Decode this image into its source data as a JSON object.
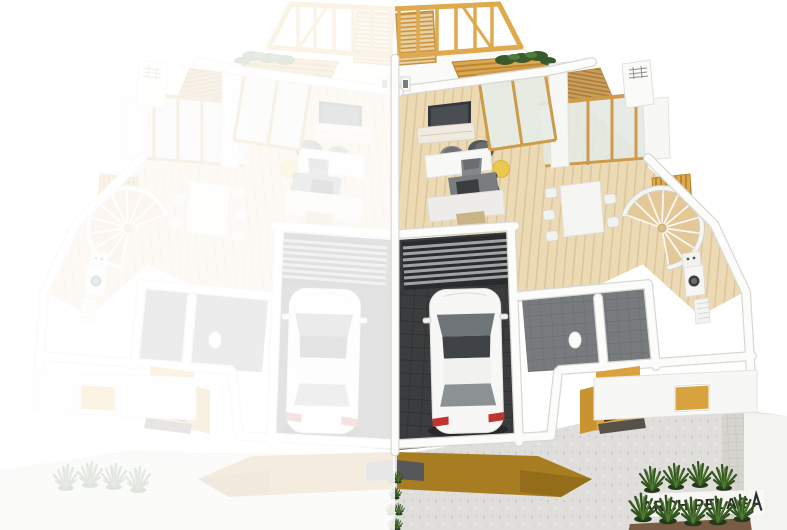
{
  "watermark": {
    "brand": "ARCHIPELAG",
    "logo_icon": "archipelag-logo"
  },
  "palette": {
    "background": "#FFFFFF",
    "timber": "#DFA94E",
    "timber_dark": "#C08A2E",
    "wood_frame": "#CE9B4B",
    "wood_floor": "#ECDAB5",
    "facade_band": "#A87C20",
    "entrance_wall": "#E2A83E",
    "garage_floor": "#3B3C3E",
    "garage_slats": "#A0A3A6",
    "wall_white": "#FCFCFA",
    "wall_shadow": "#D8D8D3",
    "concrete": "#DFDEDA",
    "glass": "#E3E9E3",
    "grass": "#33551F",
    "mulch": "#7A5B44",
    "car_body": "#F7F7F5",
    "car_glass": "#6F7478",
    "taillight": "#C0342F",
    "ghost_opacity": "0.86"
  },
  "scene": {
    "type": "3d-cutaway-floorplan-render",
    "left_unit": "ghosted mirror duplicate",
    "right_unit": "furnished color render",
    "elements": [
      "roof-truss",
      "pergola-deck",
      "conservatory",
      "chimney",
      "tv",
      "sideboard",
      "armchairs",
      "side-table",
      "floor-lamp",
      "kitchen",
      "dining-set",
      "spiral-staircase",
      "garage",
      "white-car",
      "bathroom",
      "washing-machine",
      "entrance-porch",
      "skylight",
      "driveway",
      "ornamental-grasses"
    ]
  }
}
